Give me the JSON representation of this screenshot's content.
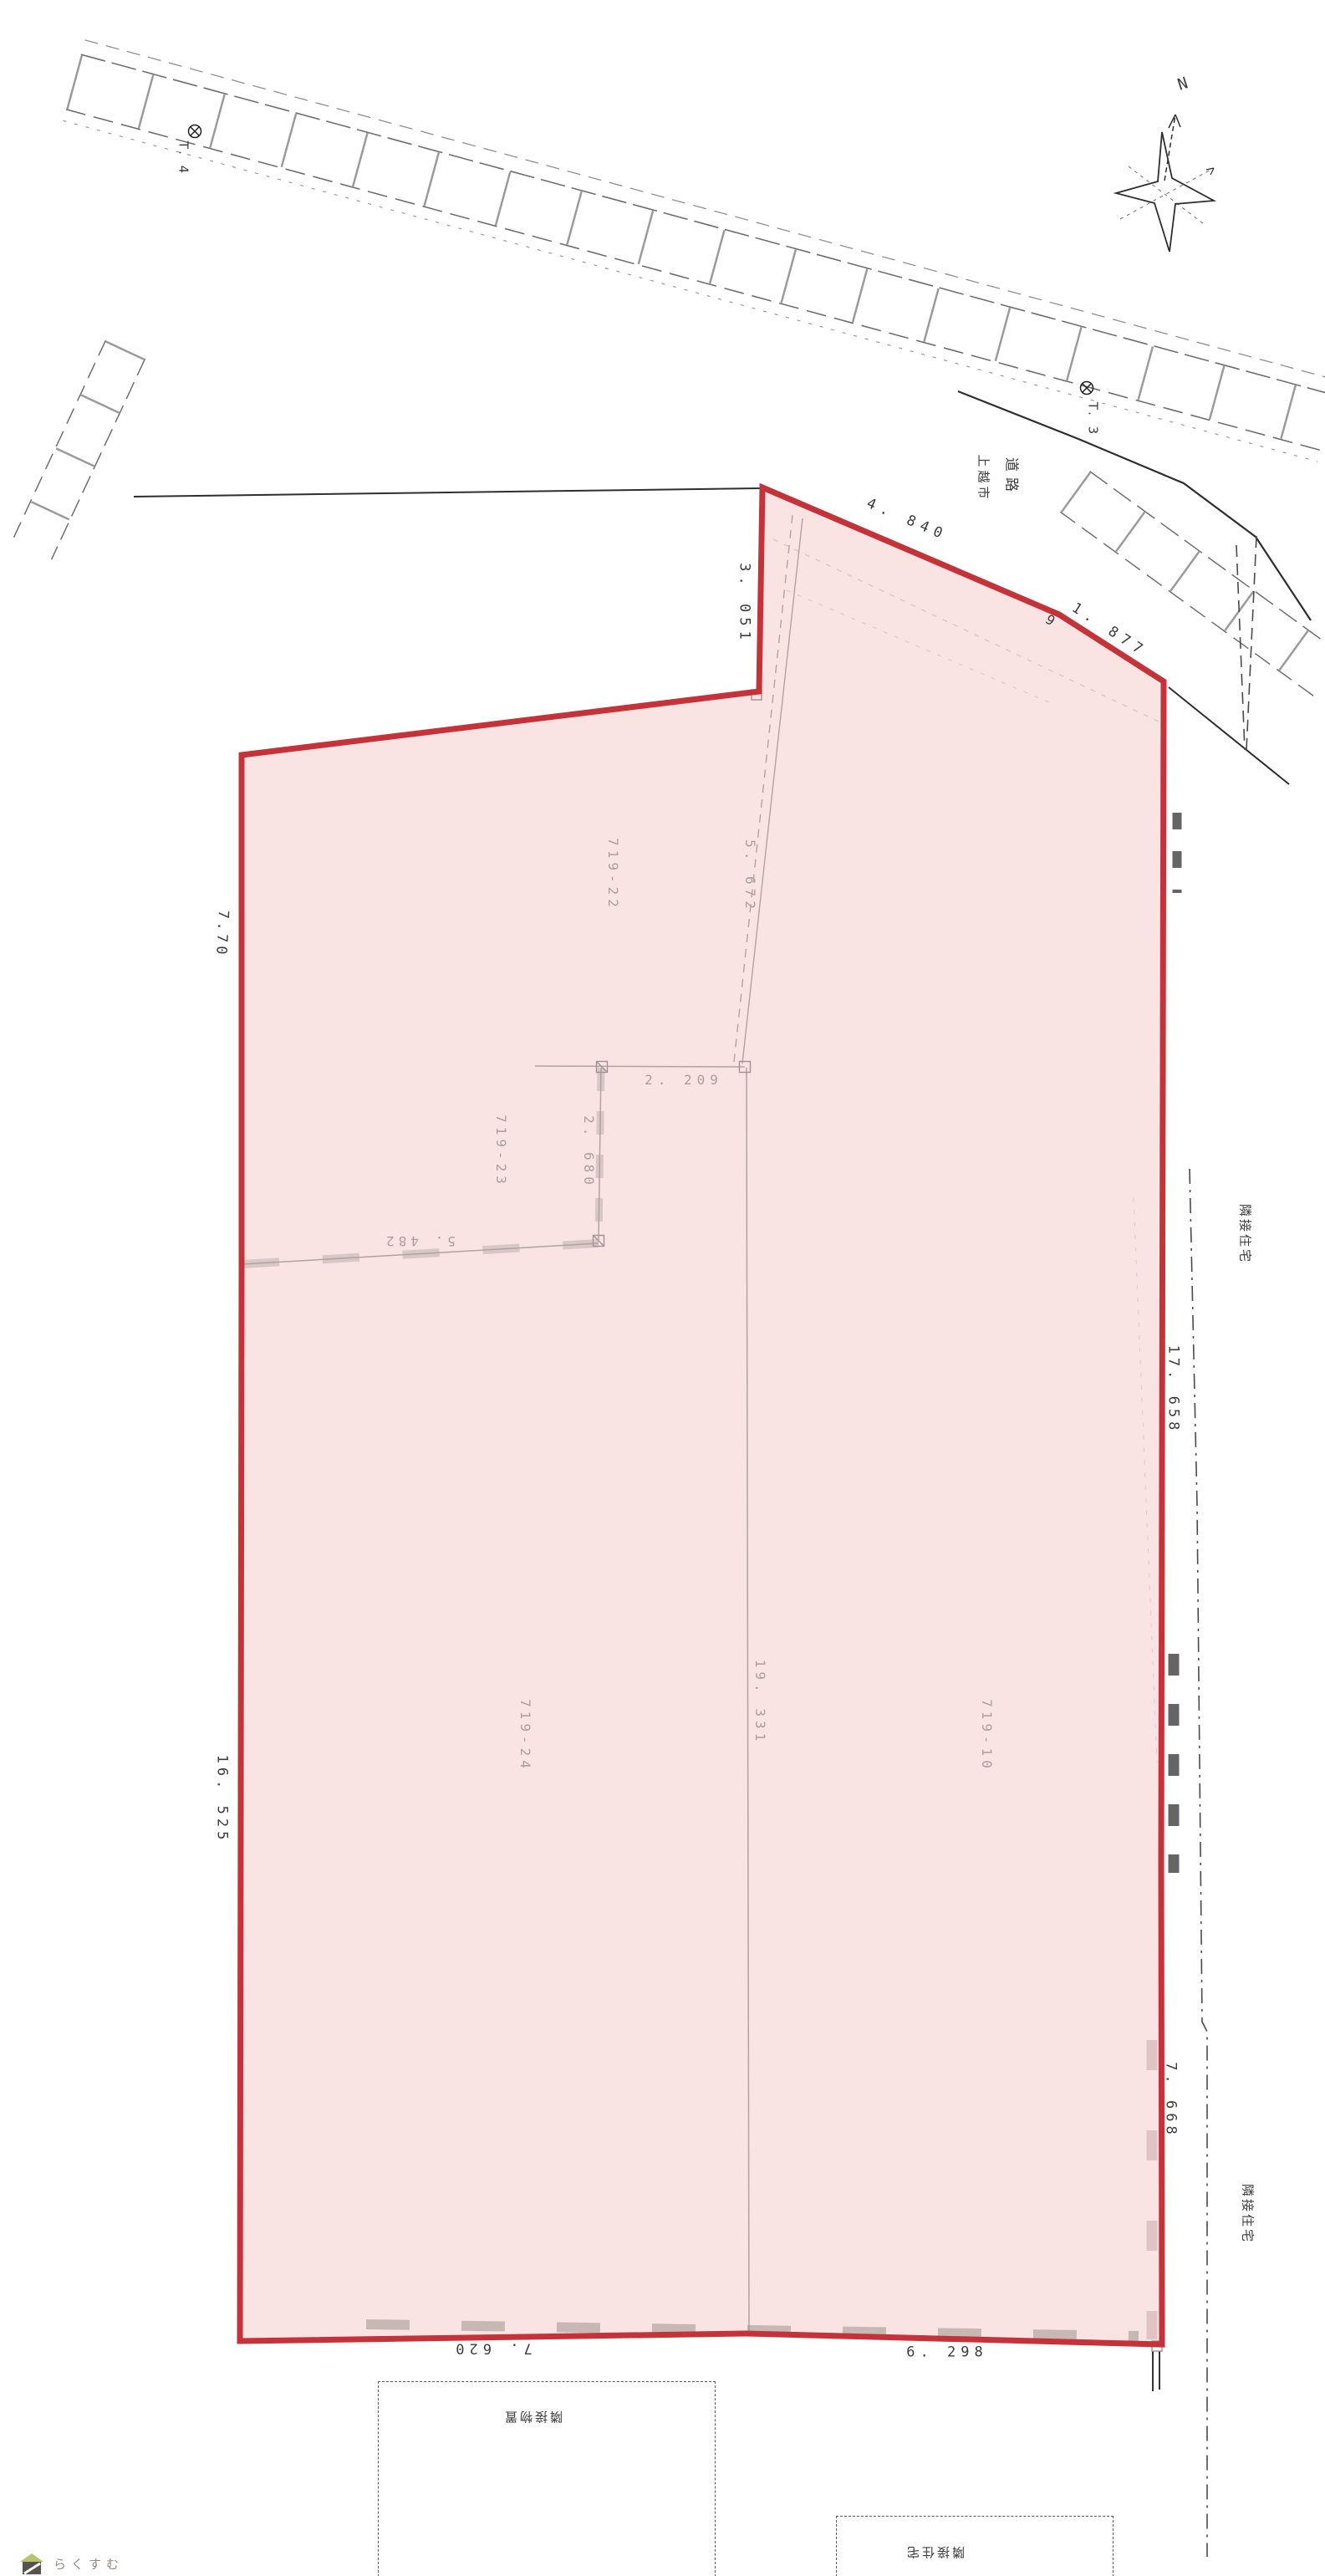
{
  "compass": {
    "n": "N"
  },
  "benchmarks": {
    "t4": "T. 4",
    "t3": "T. 3"
  },
  "places": {
    "road": "道路",
    "city": "上越市",
    "adj_house_east_upper": "隣接住宅",
    "adj_house_east_lower": "隣接住宅",
    "shed_bottom": "隣接物置",
    "adj_house_bottom": "隣接住宅"
  },
  "parcels": {
    "p22": "719-22",
    "p23": "719-23",
    "p24": "719-24",
    "p10": "719-10"
  },
  "dims": {
    "d3051": "3. 051",
    "d4840": "4. 840",
    "stray": "9",
    "d1877": "1. 877",
    "d770": "7.70",
    "d16525": "16. 525",
    "d5672": "5. 672",
    "d2209": "2. 209",
    "d2680": "2. 680",
    "d5482": "5. 482",
    "d19331": "19. 331",
    "d17658": "17. 658",
    "d7668": "7. 668",
    "d7620": "7. 620",
    "d6298": "6. 298"
  },
  "logo": {
    "text": "らくすむ"
  },
  "colors": {
    "boundary_red": "#c5333a",
    "parcel_pink": "#fae3e3",
    "faint_gray": "#b0a3a1",
    "label_gray": "#ab9da0",
    "ink": "#3d3d3d",
    "logo_green": "#b7c56d",
    "logo_dark": "#5a524e",
    "logo_text": "#938782"
  }
}
